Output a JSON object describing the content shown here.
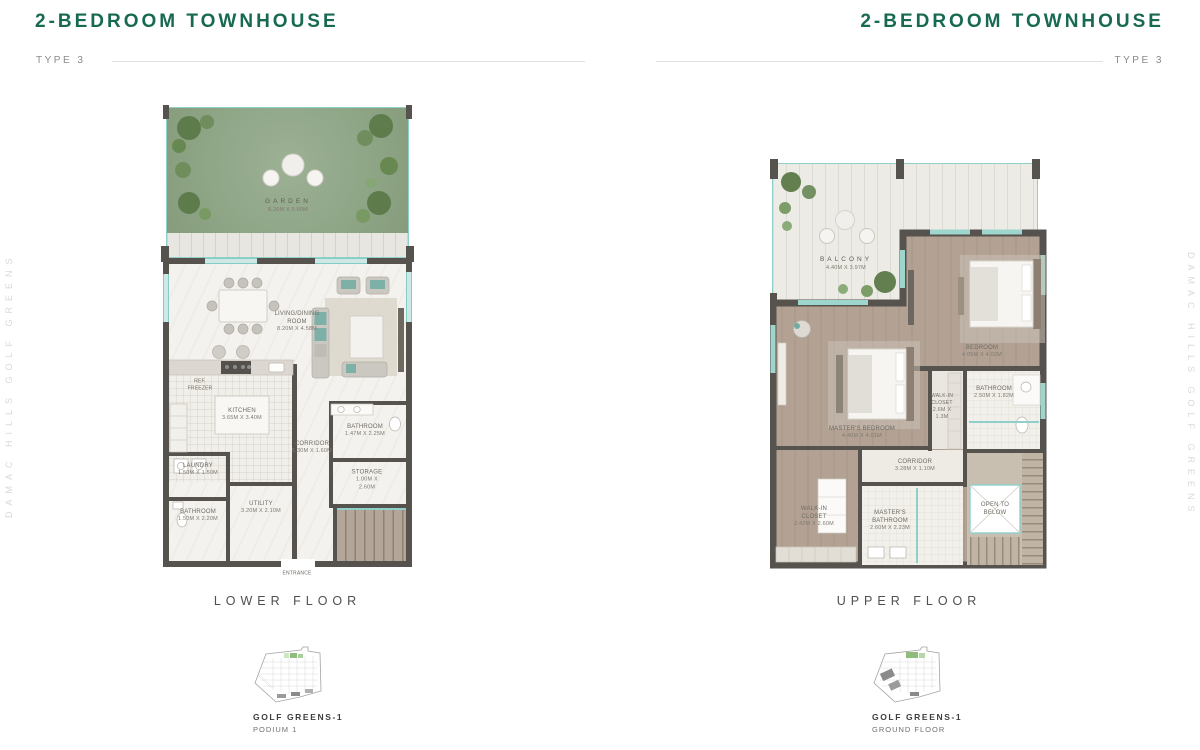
{
  "header": {
    "title": "2-BEDROOM TOWNHOUSE",
    "type_label": "TYPE 3"
  },
  "watermark": "DAMAC HILLS GOLF GREENS",
  "colors": {
    "accent_green": "#176952",
    "glass_teal": "#8fd0ca",
    "wall_gray": "#56524d"
  },
  "lower": {
    "floor_label": "LOWER FLOOR",
    "site_title": "GOLF GREENS-1",
    "site_subtitle": "PODIUM 1",
    "entrance_label": "ENTRANCE",
    "rooms": {
      "garden": {
        "name": "GARDEN",
        "dims": "8.20M X 5.60M"
      },
      "living_dining": {
        "name": "LIVING/DINING ROOM",
        "dims": "8.20M X 4.58M"
      },
      "kitchen": {
        "name": "KITCHEN",
        "dims": "3.65M X 3.40M"
      },
      "ref": {
        "name": "REF. FREEZER"
      },
      "laundry": {
        "name": "LAUNDRY",
        "dims": "1.50M X 1.50M"
      },
      "bathroom_a": {
        "name": "BATHROOM",
        "dims": "1.50M X 2.20M"
      },
      "utility": {
        "name": "UTILITY",
        "dims": "3.20M X 2.10M"
      },
      "corridor": {
        "name": "CORRIDOR",
        "dims": "5.30M X 1.60M"
      },
      "bathroom_b": {
        "name": "BATHROOM",
        "dims": "1.47M X 2.25M"
      },
      "storage": {
        "name": "STORAGE",
        "dims": "1.00M X 2.60M"
      }
    }
  },
  "upper": {
    "floor_label": "UPPER FLOOR",
    "site_title": "GOLF GREENS-1",
    "site_subtitle": "GROUND FLOOR",
    "open_to_below": "OPEN TO BELOW",
    "rooms": {
      "balcony": {
        "name": "BALCONY",
        "dims": "4.40M X 3.97M"
      },
      "bedroom": {
        "name": "BEDROOM",
        "dims": "4.05M X 4.02M"
      },
      "bathroom": {
        "name": "BATHROOM",
        "dims": "2.50M X 1.82M"
      },
      "walkin_a": {
        "name": "WALK-IN CLOSET",
        "dims": "2.6M X 1.3M"
      },
      "master_bedroom": {
        "name": "MASTER'S BEDROOM",
        "dims": "4.40M X 4.01M"
      },
      "corridor": {
        "name": "CORRIDOR",
        "dims": "3.28M X 1.10M"
      },
      "walkin_b": {
        "name": "WALK-IN CLOSET",
        "dims": "2.42M X 2.60M"
      },
      "master_bathroom": {
        "name": "MASTER'S BATHROOM",
        "dims": "2.60M X 2.23M"
      }
    }
  }
}
